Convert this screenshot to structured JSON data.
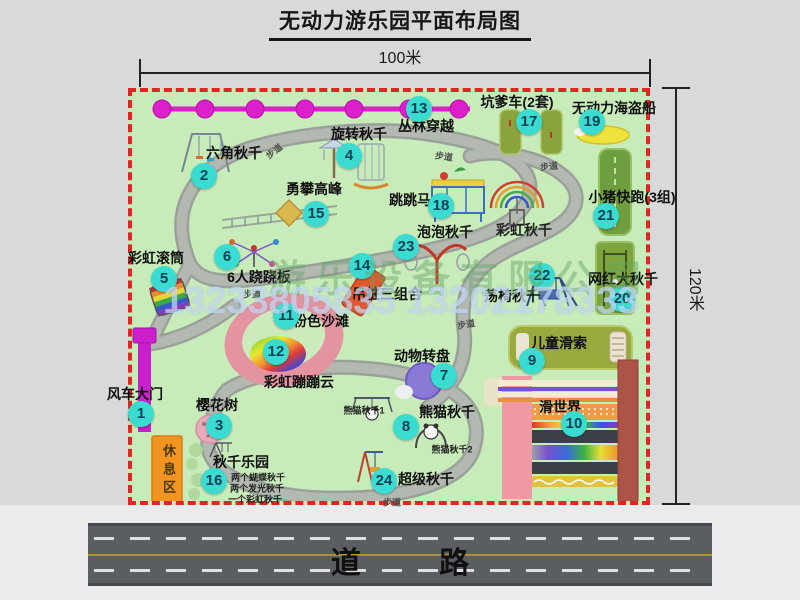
{
  "title": "无动力游乐园平面布局图",
  "scale": {
    "width_label": "100米",
    "height_label": "120米"
  },
  "road": {
    "label": "道 路"
  },
  "watermark": {
    "company": "游乐设备有限公司",
    "phone": "13233805835 13202178333"
  },
  "map": {
    "rest_area_label": "休息区",
    "attractions": [
      {
        "num": 1,
        "name": "风车大门",
        "marker": [
          9,
          322
        ],
        "label": [
          3,
          302
        ]
      },
      {
        "num": 2,
        "name": "六角秋千",
        "marker": [
          72,
          84
        ],
        "label": [
          102,
          61
        ]
      },
      {
        "num": 3,
        "name": "樱花树",
        "marker": [
          87,
          334
        ],
        "label": [
          85,
          313
        ]
      },
      {
        "num": 4,
        "name": "旋转秋千",
        "marker": [
          217,
          64
        ],
        "label": [
          227,
          42
        ]
      },
      {
        "num": 5,
        "name": "彩虹滚筒",
        "marker": [
          32,
          187
        ],
        "label": [
          24,
          166
        ]
      },
      {
        "num": 6,
        "name": "6人跷跷板",
        "marker": [
          95,
          165
        ],
        "label": [
          127,
          185
        ]
      },
      {
        "num": 7,
        "name": "动物转盘",
        "marker": [
          312,
          284
        ],
        "label": [
          290,
          264
        ]
      },
      {
        "num": 8,
        "name": "熊猫秋千",
        "marker": [
          274,
          335
        ],
        "label": [
          315,
          320
        ]
      },
      {
        "num": 9,
        "name": "儿童滑索",
        "marker": [
          400,
          269
        ],
        "label": [
          427,
          251
        ]
      },
      {
        "num": 10,
        "name": "滑世界",
        "marker": [
          442,
          332
        ],
        "label": [
          428,
          315
        ]
      },
      {
        "num": 11,
        "name": "粉色沙滩",
        "marker": [
          154,
          224
        ],
        "label": [
          189,
          229
        ]
      },
      {
        "num": 12,
        "name": "彩虹蹦蹦云",
        "marker": [
          144,
          260
        ],
        "label": [
          167,
          290
        ]
      },
      {
        "num": 13,
        "name": "丛林穿越",
        "marker": [
          287,
          17
        ],
        "label": [
          294,
          34
        ]
      },
      {
        "num": 14,
        "name": "吊桩三组合",
        "marker": [
          230,
          174
        ],
        "label": [
          255,
          202
        ]
      },
      {
        "num": 15,
        "name": "勇攀高峰",
        "marker": [
          184,
          122
        ],
        "label": [
          182,
          97
        ]
      },
      {
        "num": 16,
        "name": "秋千乐园",
        "marker": [
          82,
          389
        ],
        "label": [
          109,
          370
        ]
      },
      {
        "num": 17,
        "name": "坑爹车(2套)",
        "marker": [
          397,
          30
        ],
        "label": [
          385,
          10
        ]
      },
      {
        "num": 18,
        "name": "跳跳马",
        "marker": [
          309,
          114
        ],
        "label": [
          278,
          108
        ]
      },
      {
        "num": 19,
        "name": "无动力海盗船",
        "marker": [
          460,
          30
        ],
        "label": [
          482,
          16
        ]
      },
      {
        "num": 20,
        "name": "网红大秋千",
        "marker": [
          490,
          207
        ],
        "label": [
          491,
          187
        ]
      },
      {
        "num": 21,
        "name": "小猪快跑(3组)",
        "marker": [
          474,
          124
        ],
        "label": [
          500,
          105
        ]
      },
      {
        "num": 22,
        "name": "荡椅秋千",
        "marker": [
          410,
          184
        ],
        "label": [
          380,
          204
        ]
      },
      {
        "num": 23,
        "name": "泡泡秋千",
        "marker": [
          274,
          155
        ],
        "label": [
          313,
          140
        ]
      },
      {
        "num": 24,
        "name": "超级秋千",
        "marker": [
          252,
          389
        ],
        "label": [
          294,
          387
        ]
      }
    ],
    "annotations": [
      {
        "text": "彩虹秋千",
        "pos": [
          392,
          138
        ],
        "size": 14
      },
      {
        "text": "熊猫秋千1",
        "pos": [
          232,
          318
        ],
        "size": 9
      },
      {
        "text": "熊猫秋千2",
        "pos": [
          320,
          357
        ],
        "size": 9
      },
      {
        "text": "两个蝴蝶秋千",
        "pos": [
          126,
          385
        ],
        "size": 9
      },
      {
        "text": "两个发光秋千",
        "pos": [
          125,
          396
        ],
        "size": 9
      },
      {
        "text": "一个彩虹秋千",
        "pos": [
          123,
          407
        ],
        "size": 9
      }
    ],
    "path_labels": [
      {
        "text": "步道",
        "pos": [
          142,
          59
        ],
        "rot": -38
      },
      {
        "text": "步道",
        "pos": [
          312,
          64
        ],
        "rot": 8
      },
      {
        "text": "步道",
        "pos": [
          417,
          74
        ],
        "rot": -6
      },
      {
        "text": "步道",
        "pos": [
          120,
          202
        ],
        "rot": 0
      },
      {
        "text": "步道",
        "pos": [
          334,
          232
        ],
        "rot": -10
      },
      {
        "text": "步道",
        "pos": [
          260,
          410
        ],
        "rot": 0
      }
    ]
  }
}
